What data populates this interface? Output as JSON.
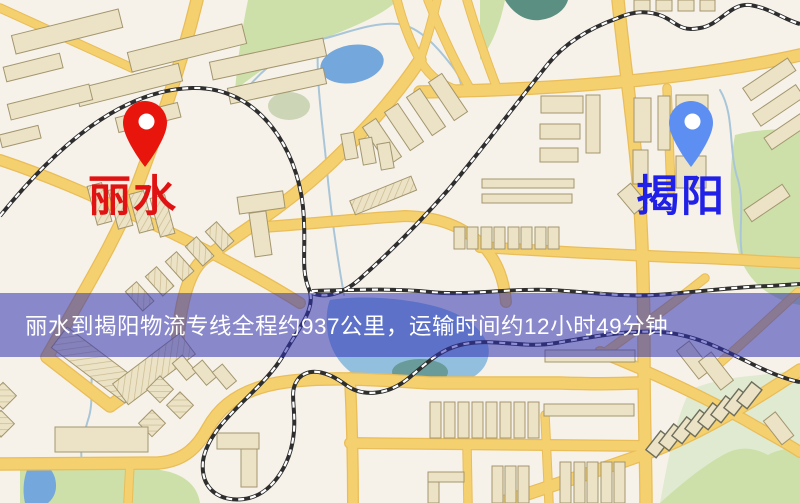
{
  "banner": {
    "text": "丽水到揭阳物流专线全程约937公里，运输时间约12小时49分钟."
  },
  "route": {
    "origin": "丽水",
    "destination": "揭阳",
    "distance": "937公里",
    "duration": "12小时49分钟"
  },
  "markers": {
    "origin": {
      "label": "丽水"
    },
    "destination": {
      "label": "揭阳"
    }
  },
  "theme": {
    "bg": "#f7f2e9",
    "road": "#f5d06e",
    "road-edge": "#e9bd59",
    "bld": "#ece3c6",
    "bld-edge": "#a3966f",
    "bld-edge-dark": "#6e6e5c",
    "green": "#cde0a9",
    "green-muted": "#ccd5b6",
    "green-pale": "#e0ead0",
    "teal": "#5a8f82",
    "water": "#74a7dc",
    "water2": "#93bfdf",
    "stream": "#a9c6d9",
    "rail": "#2e2e2e",
    "rail-dash": "#ffffff",
    "banner-bg": "rgba(47,49,178,0.55)",
    "banner-text": "#ffffff",
    "pin-origin": "#e8150d",
    "label-origin": "#e01212",
    "pin-dest": "#5d8ef2",
    "label-dest": "#2020e6"
  }
}
